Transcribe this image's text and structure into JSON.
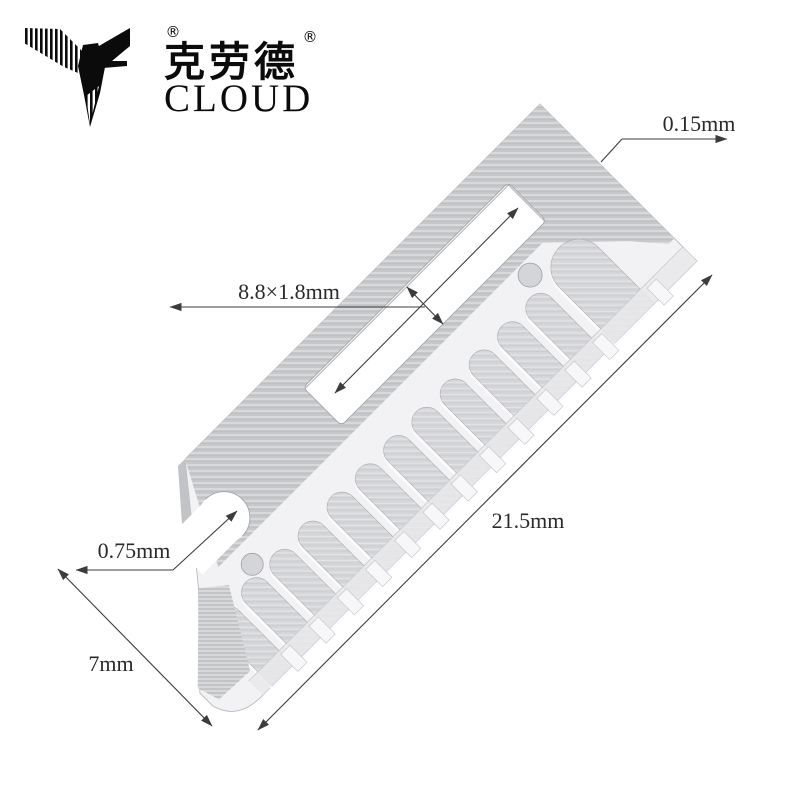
{
  "brand": {
    "registered": "®",
    "name_cn": "克劳德",
    "name_en": "CLOUD"
  },
  "dimensions": {
    "thickness": "0.15mm",
    "slot_size": "8.8×1.8mm",
    "blade_length": "21.5mm",
    "notch": "0.75mm",
    "blade_width": "7mm"
  },
  "colors": {
    "background": "#ffffff",
    "metal_dark": "#c7c8cb",
    "metal_face": "#f2f2f4",
    "slot_gray": "#d5d6d9",
    "edge_band": "#e9e9eb",
    "dimension_line": "#3c3c3c",
    "text": "#2a2a2a",
    "logo": "#0b0b0b"
  }
}
